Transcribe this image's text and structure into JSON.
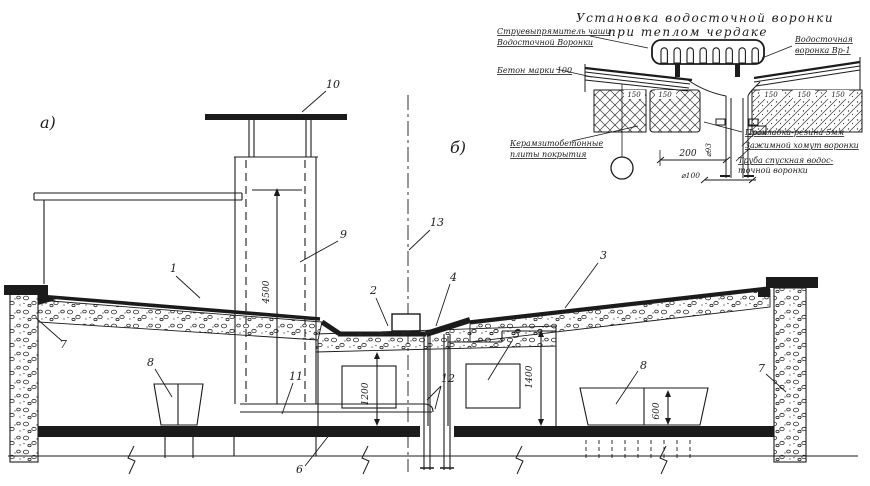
{
  "main": {
    "label": "а)",
    "callouts": [
      "1",
      "2",
      "3",
      "4",
      "5",
      "6",
      "7",
      "8",
      "9",
      "10",
      "11",
      "12",
      "13"
    ],
    "dims": {
      "shaft": "4500",
      "chamber": "1200",
      "attic": "1400",
      "support": "600"
    }
  },
  "detail": {
    "label": "б)",
    "title1": "Установка водосточной воронки",
    "title2": "при теплом чердаке",
    "labels": {
      "straightener1": "Струевыпрямитель чаши",
      "straightener2": "Водосточной Воронки",
      "concrete": "Бетон марки 100",
      "slab1": "Керамзитобетонные",
      "slab2": "плиты покрытия",
      "funnel1": "Водосточная",
      "funnel2": "воронка Вр-1",
      "gasket": "Прокладка-резина 5мм",
      "clamp": "Зажимной хомут воронки",
      "pipe1": "Труба спускная водос-",
      "pipe2": "точной воронки"
    },
    "dims": {
      "offset": "200",
      "slabs": [
        "150",
        "150",
        "150",
        "150",
        "150"
      ],
      "pipe": "⌀100",
      "pipe_small": "⌀93"
    }
  },
  "colors": {
    "ink": "#1b1b1b",
    "paper": "#ffffff"
  }
}
